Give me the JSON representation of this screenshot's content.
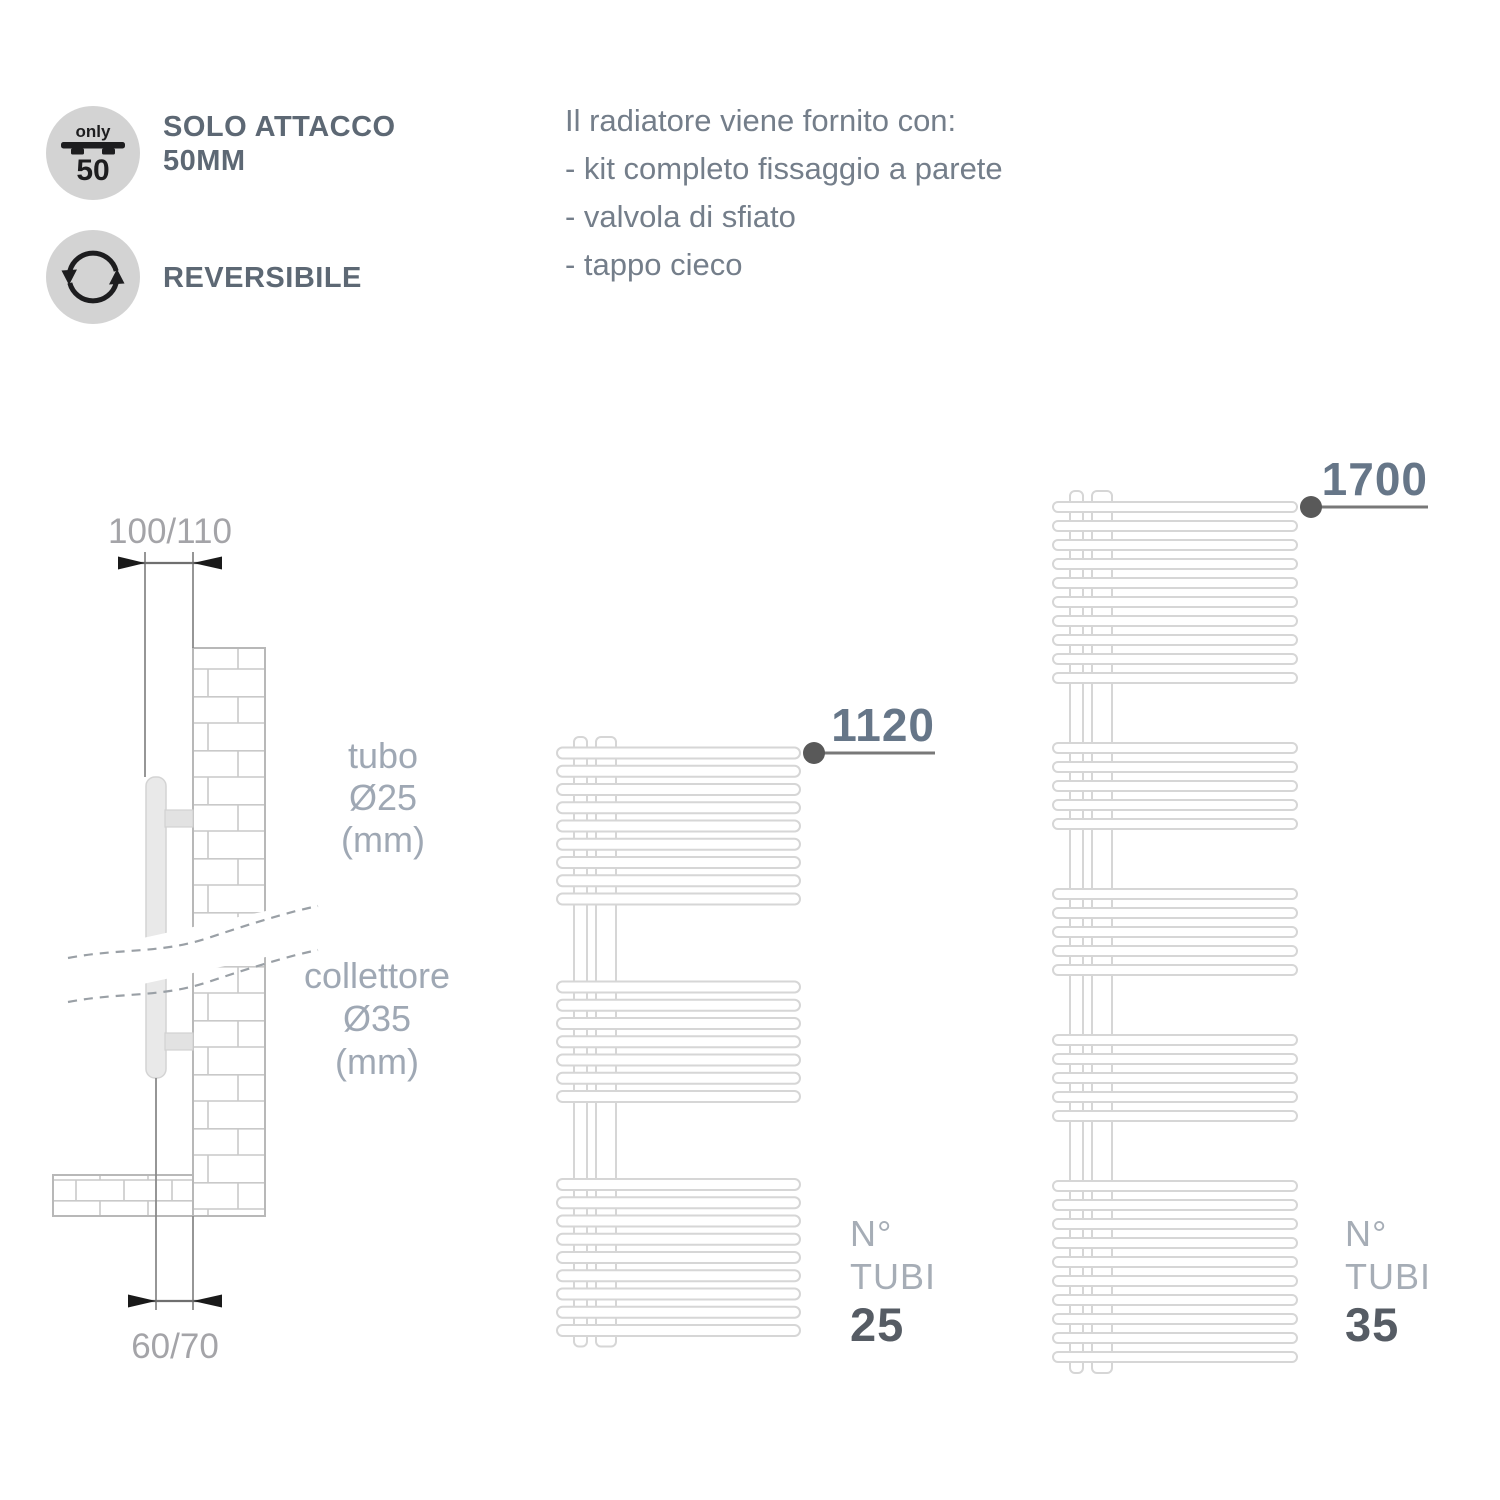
{
  "features": [
    {
      "icon": "only-50-bracket-icon",
      "icon_text_top": "only",
      "icon_text_bottom": "50",
      "label_line1": "SOLO ATTACCO",
      "label_line2": "50MM"
    },
    {
      "icon": "reversible-arrows-icon",
      "label_line1": "REVERSIBILE",
      "label_line2": ""
    }
  ],
  "supply_info": {
    "title": "Il radiatore viene fornito con:",
    "items": [
      "- kit completo fissaggio a parete",
      "- valvola di sfiato",
      "- tappo cieco"
    ]
  },
  "side_view": {
    "dim_top": "100/110",
    "dim_bottom": "60/70",
    "tube_label_lines": [
      "tubo",
      "Ø25",
      "(mm)"
    ],
    "collector_label_lines": [
      "collettore",
      "Ø35",
      "(mm)"
    ]
  },
  "radiators": [
    {
      "height_label": "1120",
      "count_label_line1": "N°",
      "count_label_line2": "TUBI",
      "tube_count": "25",
      "tube_groups": [
        9,
        7,
        9
      ]
    },
    {
      "height_label": "1700",
      "count_label_line1": "N°",
      "count_label_line2": "TUBI",
      "tube_count": "35",
      "tube_groups": [
        10,
        5,
        5,
        5,
        10
      ]
    }
  ],
  "colors": {
    "feature_label": "#5d6874",
    "body_text": "#747e8a",
    "dim_text": "#a4a4a8",
    "drawing_label": "#9fa8b4",
    "callout_number": "#667688",
    "callout_line": "#787878",
    "callout_dot": "#595959",
    "count_light": "#a6adb6",
    "count_bold": "#565c64",
    "tube_outline": "#d6d6d6",
    "icon_circle": "#d3d3d3",
    "icon_glyph": "#1d1d1f"
  }
}
